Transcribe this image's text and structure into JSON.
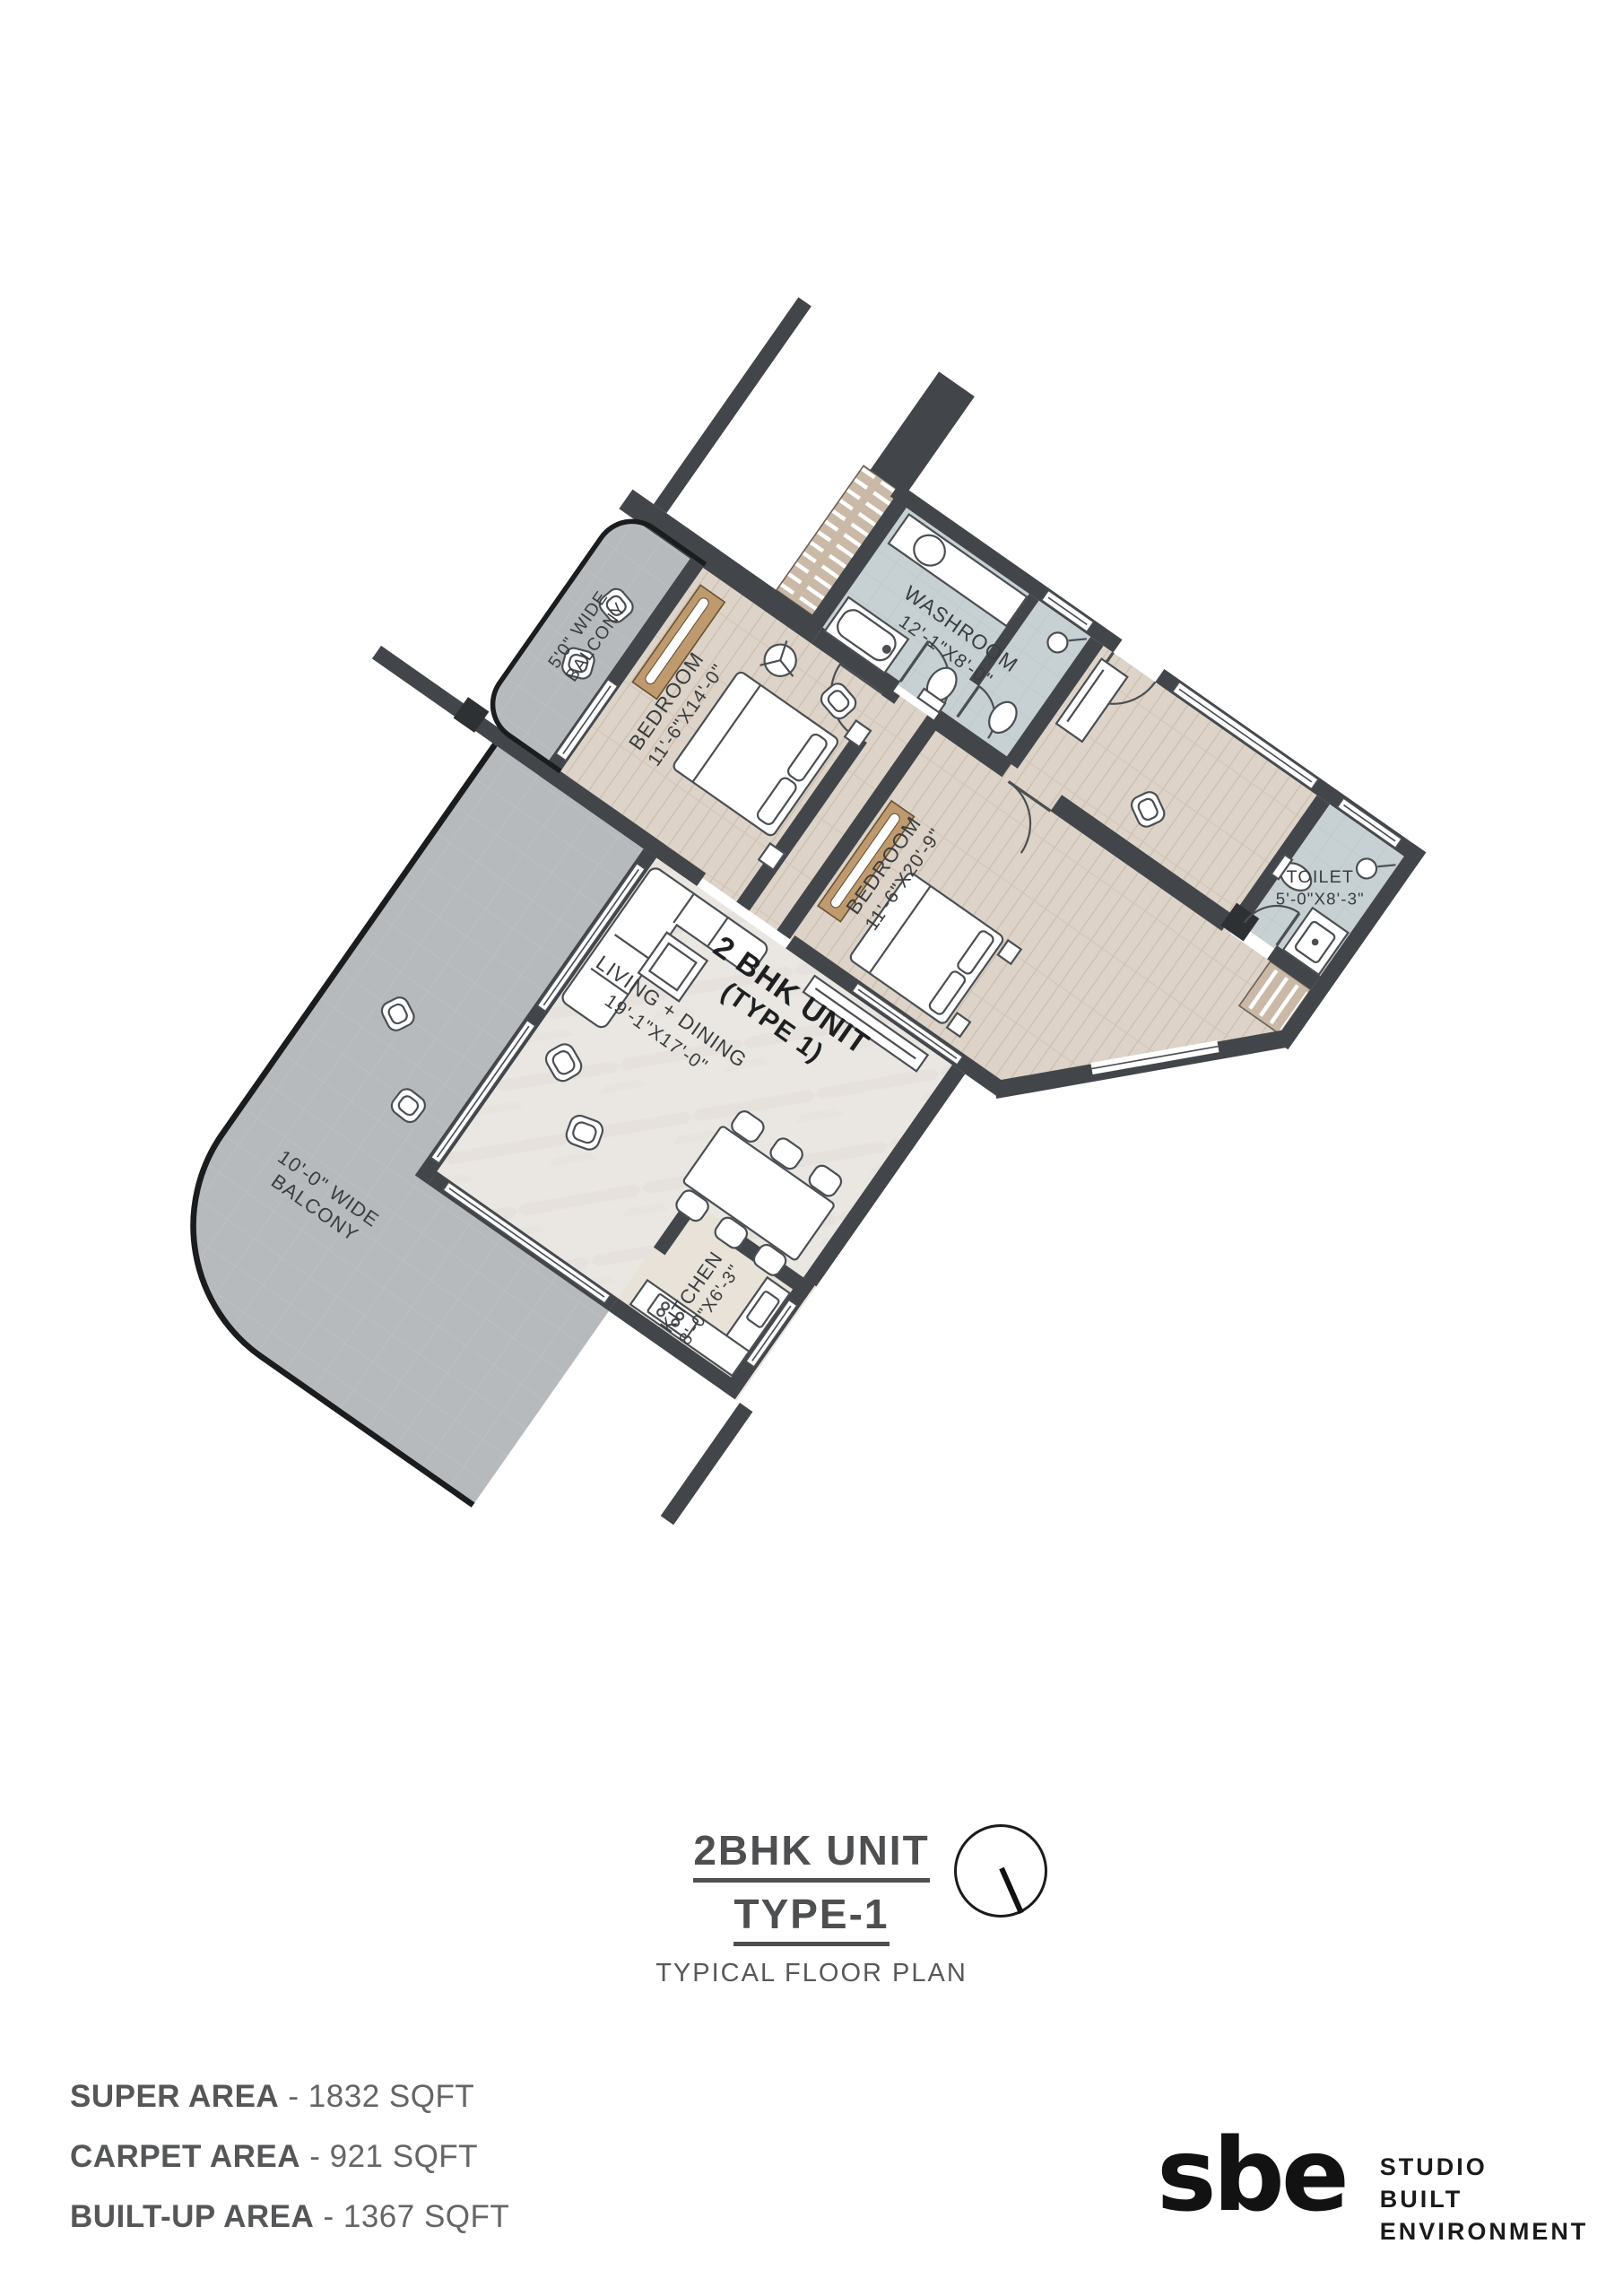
{
  "unit": {
    "line1": "2 BHK UNIT",
    "line2": "(TYPE 1)"
  },
  "rooms": {
    "washroom": {
      "name": "WASHROOM",
      "dims": "12'-1\"X8'-0\""
    },
    "toilet": {
      "name": "TOILET",
      "dims": "5'-0\"X8'-3\""
    },
    "bedroom1": {
      "name": "BEDROOM",
      "dims": "11'-6\"X14'-0\""
    },
    "bedroom2": {
      "name": "BEDROOM",
      "dims": "11'-6\"X20'-9\""
    },
    "living": {
      "name": "LIVING + DINING",
      "dims": "19'-1\"X17'-0\""
    },
    "kitchen": {
      "name": "KITCHEN",
      "dims": "8'-0\"X6'-3\""
    },
    "balcony_small": {
      "line1": "5'0\" WIDE",
      "line2": "BALCONY"
    },
    "balcony_large": {
      "line1": "10'-0\" WIDE",
      "line2": "BALCONY"
    }
  },
  "title": {
    "line1": "2BHK UNIT",
    "line2": "TYPE-1",
    "subtitle": "TYPICAL FLOOR PLAN"
  },
  "areas": [
    {
      "label": "SUPER AREA",
      "value": "- 1832 SQFT"
    },
    {
      "label": "CARPET AREA",
      "value": "- 921 SQFT"
    },
    {
      "label": "BUILT-UP AREA",
      "value": "- 1367 SQFT"
    }
  ],
  "logo": {
    "mark": "sbe",
    "line1": "STUDIO",
    "line2": "BUILT",
    "line3": "ENVIRONMENT"
  },
  "colors": {
    "wall": "#42464a",
    "wood_floor": "#ddd3c8",
    "marble_floor": "#eae7e2",
    "bath_floor": "#c7d0d3",
    "balcony_floor": "#b6babc",
    "wardrobe": "#bf9a6f",
    "hatch_band": "#cbb9a7",
    "label_text": "#3a3d40",
    "railing": "#1a1c1e"
  }
}
